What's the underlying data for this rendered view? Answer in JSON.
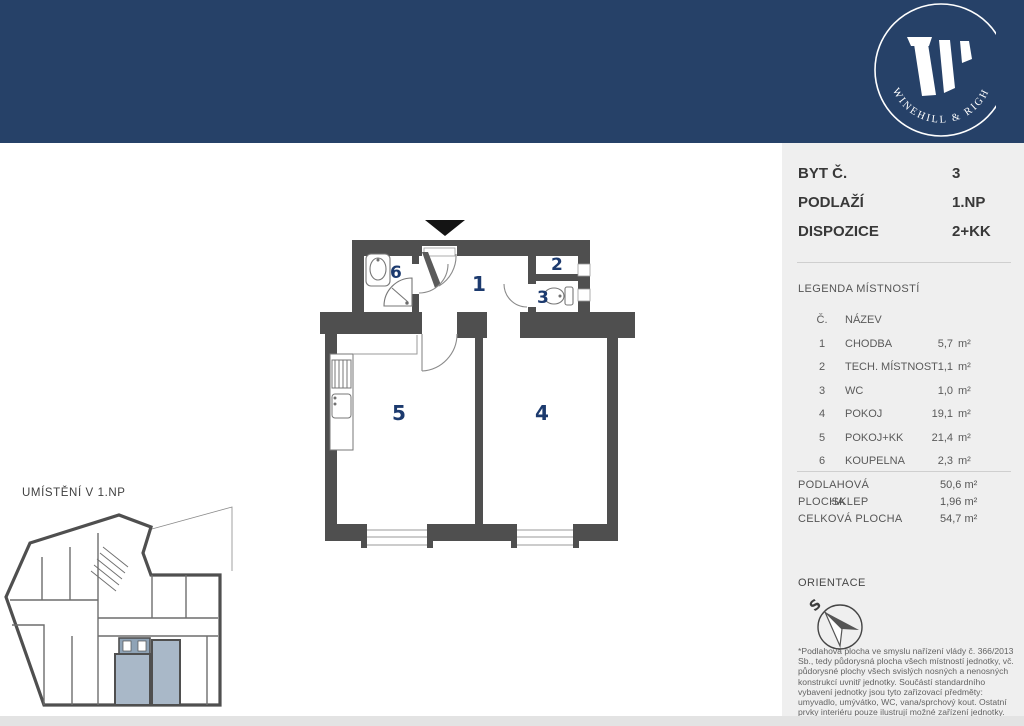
{
  "brand": {
    "arc_text": "WINEHILL & RIGH",
    "band_color": "#264168"
  },
  "unit_info": {
    "rows": [
      {
        "label": "BYT Č.",
        "value": "3"
      },
      {
        "label": "PODLAŽÍ",
        "value": "1.NP"
      },
      {
        "label": "DISPOZICE",
        "value": "2+KK"
      }
    ]
  },
  "legend": {
    "title": "LEGENDA MÍSTNOSTÍ",
    "col_no": "Č.",
    "col_name": "NÁZEV",
    "rows": [
      {
        "no": "1",
        "name": "CHODBA",
        "area": "5,7",
        "unit": "m²"
      },
      {
        "no": "2",
        "name": "TECH. MÍSTNOST",
        "area": "1,1",
        "unit": "m²"
      },
      {
        "no": "3",
        "name": "WC",
        "area": "1,0",
        "unit": "m²"
      },
      {
        "no": "4",
        "name": "POKOJ",
        "area": "19,1",
        "unit": "m²"
      },
      {
        "no": "5",
        "name": "POKOJ+KK",
        "area": "21,4",
        "unit": "m²"
      },
      {
        "no": "6",
        "name": "KOUPELNA",
        "area": "2,3",
        "unit": "m²"
      }
    ]
  },
  "totals": {
    "rows": [
      {
        "label": "PODLAHOVÁ PLOCHA",
        "value": "50,6 m²"
      },
      {
        "label": "SKLEP",
        "value": "1,96 m²"
      },
      {
        "label": "CELKOVÁ PLOCHA",
        "value": "54,7 m²"
      }
    ]
  },
  "orientation": {
    "title": "ORIENTACE",
    "north_letter": "S"
  },
  "disclaimer": "*Podlahová plocha ve smyslu nařízení vlády č. 366/2013 Sb., tedy půdorysná plocha všech místností jednotky, vč. půdorysné plochy všech svislých nosných a nenosných konstrukcí uvnitř jednotky. Součástí standardního vybavení jednotky jsou tyto zařizovací předměty: umyvadlo, umývátko, WC, vana/sprchový kout. Ostatní prvky interiéru pouze ilustrují možné zařízení jednotky.",
  "floor_plan": {
    "labels": {
      "r1": "1",
      "r2": "2",
      "r3": "3",
      "r4": "4",
      "r5": "5",
      "r6": "6"
    },
    "wall_color": "#4f4f4f",
    "label_color": "#1c3a6e"
  },
  "mini_plan": {
    "title": "UMÍSTĚNÍ V 1.NP",
    "highlight_color": "#a9b8c8"
  }
}
